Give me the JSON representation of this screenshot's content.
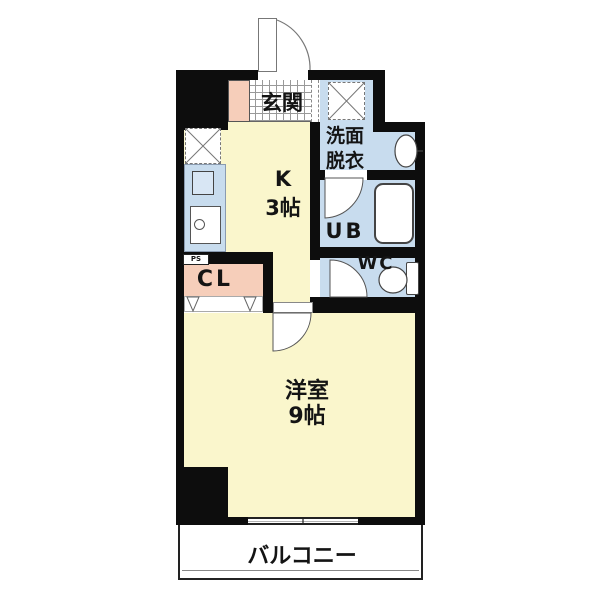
{
  "floorplan": {
    "kind": "1K apartment floor plan",
    "colors": {
      "wall": "#0d0d0d",
      "room_floor": "#FAF6CC",
      "wet_floor": "#C8DCEE",
      "closet_floor": "#F6CEBA",
      "balcony_floor": "#ffffff"
    },
    "rooms": {
      "genkan": {
        "label": "玄関"
      },
      "kitchen": {
        "label": "K",
        "size": "3帖"
      },
      "washroom": {
        "label_line1": "洗面",
        "label_line2": "脱衣"
      },
      "unit_bath": {
        "label": "UB"
      },
      "toilet": {
        "label": "WC"
      },
      "closet": {
        "label": "CL"
      },
      "pipe_space": {
        "label": "PS"
      },
      "main_room": {
        "label": "洋室",
        "size": "9帖"
      },
      "balcony": {
        "label": "バルコニー"
      }
    }
  }
}
